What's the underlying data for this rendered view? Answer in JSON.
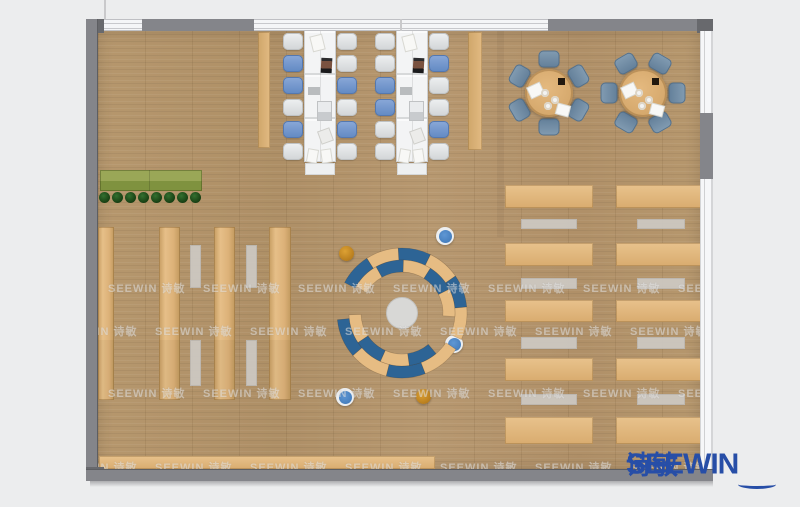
{
  "page": {
    "width": 800,
    "height": 507,
    "bg": "#ecedee"
  },
  "logo": {
    "en": "SEEWIN",
    "cn": "诗敏",
    "color": "#274ea7"
  },
  "watermark": {
    "text": "SEEWIN 诗敏",
    "tile": 95,
    "rows": [
      {
        "y": 280,
        "x0": 10
      },
      {
        "y": 323,
        "x0": -38
      },
      {
        "y": 385,
        "x0": 10
      },
      {
        "y": 459,
        "x0": -38
      }
    ]
  },
  "palette": {
    "wall": "#84858a",
    "wall_dark": "#68696d",
    "arc_blue": "#2d6495",
    "arc_tan": "#e6bc83",
    "hub": "#d8d8d6",
    "hub_edge": "#c2c2c0",
    "planter_top": "#9aa757",
    "planter_bottom": "#7f923f"
  },
  "room": {
    "floor": {
      "x": 98,
      "y": 31,
      "w": 602,
      "h": 438
    },
    "top_wall": {
      "y": 19,
      "h": 12,
      "segments": [
        {
          "x": 86,
          "w": 18,
          "t": "dark"
        },
        {
          "x": 104,
          "w": 38,
          "t": "glass"
        },
        {
          "x": 142,
          "w": 112,
          "t": "wall"
        },
        {
          "x": 254,
          "w": 294,
          "t": "glass"
        },
        {
          "x": 548,
          "w": 149,
          "t": "wall"
        },
        {
          "x": 697,
          "w": 16,
          "t": "dark"
        }
      ]
    },
    "glass_divider_x": 400,
    "left_wall": {
      "x": 86,
      "y": 19,
      "w": 12,
      "h": 462
    },
    "bottom_wall": {
      "x": 86,
      "y": 469,
      "w": 627,
      "h": 12
    },
    "right_window": {
      "x": 700,
      "y": 31,
      "w": 13,
      "h": 438,
      "gray_seg": {
        "y": 113,
        "h": 66
      }
    },
    "exterior_line": {
      "x": 104,
      "y": 0,
      "h": 19
    }
  },
  "furniture": {
    "planter": {
      "x": 100,
      "y": 170,
      "w": 102,
      "h": 21,
      "plants": {
        "n": 8,
        "y": 197,
        "x0": 104,
        "gap": 13,
        "d": 11
      }
    },
    "left_shelves": {
      "y": 227,
      "h": 173,
      "items": [
        {
          "x": 98,
          "w": 16
        },
        {
          "x": 159,
          "w": 21
        },
        {
          "x": 214,
          "w": 21
        },
        {
          "x": 269,
          "w": 22
        }
      ]
    },
    "left_benches": {
      "w": 11,
      "cols": [
        190,
        246
      ],
      "segs": [
        {
          "y": 245,
          "h": 43
        },
        {
          "y": 340,
          "h": 46
        }
      ]
    },
    "pillars": [
      {
        "x": 258,
        "y": 32,
        "w": 12,
        "h": 116
      },
      {
        "x": 468,
        "y": 32,
        "w": 14,
        "h": 118
      }
    ],
    "long_tables": {
      "y": 30,
      "w": 32,
      "h": 132,
      "cap_h": 12,
      "chair_w": 20,
      "chair_h": 17,
      "row_gap": 22,
      "first_cy": 41,
      "tables": [
        {
          "x": 304,
          "left": [
            "white",
            "blue",
            "blue",
            "white",
            "blue",
            "white"
          ],
          "right": [
            "white",
            "white",
            "blue",
            "white",
            "blue",
            "white"
          ]
        },
        {
          "x": 396,
          "left": [
            "white",
            "white",
            "blue",
            "blue",
            "white",
            "white"
          ],
          "right": [
            "white",
            "blue",
            "white",
            "white",
            "blue",
            "white"
          ]
        }
      ],
      "items": [
        {
          "t": "paper",
          "dx": 8,
          "dy": 6,
          "w": 11,
          "h": 14,
          "rot": -14
        },
        {
          "t": "laptop_dark",
          "dx": 17,
          "dy": 28,
          "w": 11,
          "h": 15,
          "rot": 3
        },
        {
          "t": "pad",
          "dx": 4,
          "dy": 57,
          "w": 12,
          "h": 8,
          "rot": 0
        },
        {
          "t": "laptop_light",
          "dx": 14,
          "dy": 72,
          "w": 13,
          "h": 18,
          "rot": 0
        },
        {
          "t": "tablet",
          "dx": 16,
          "dy": 100,
          "w": 11,
          "h": 12,
          "rot": -20
        },
        {
          "t": "paper",
          "dx": 4,
          "dy": 120,
          "w": 9,
          "h": 12,
          "rot": 10
        },
        {
          "t": "paper",
          "dx": 18,
          "dy": 120,
          "w": 9,
          "h": 12,
          "rot": -8
        }
      ]
    },
    "round_tables": {
      "r": 24,
      "chair_dist": 34,
      "chair_w": 21,
      "chair_h": 17,
      "tables": [
        {
          "cx": 549,
          "cy": 93,
          "angles": [
            0,
            60,
            120,
            180,
            240,
            300
          ]
        },
        {
          "cx": 643,
          "cy": 93,
          "angles": [
            30,
            90,
            150,
            210,
            270,
            330
          ]
        }
      ],
      "items": [
        {
          "t": "paper",
          "dx": -20,
          "dy": -8,
          "w": 13,
          "h": 11,
          "rot": -25
        },
        {
          "t": "paper",
          "dx": 8,
          "dy": 12,
          "w": 12,
          "h": 10,
          "rot": 15
        },
        {
          "t": "dark",
          "dx": 9,
          "dy": -15,
          "w": 7,
          "h": 7,
          "rot": 0
        },
        {
          "t": "plate",
          "dx": -8,
          "dy": -4,
          "w": 8,
          "h": 8,
          "rot": 0
        },
        {
          "t": "plate",
          "dx": 2,
          "dy": 3,
          "w": 8,
          "h": 8,
          "rot": 0
        },
        {
          "t": "plate",
          "dx": -5,
          "dy": 9,
          "w": 8,
          "h": 8,
          "rot": 0
        }
      ]
    },
    "right_desks": {
      "cols": [
        {
          "x": 505,
          "w": 88,
          "bx": 521,
          "bw": 56
        },
        {
          "x": 616,
          "w": 85,
          "bx": 637,
          "bw": 48
        }
      ],
      "rows": [
        {
          "y": 185,
          "h": 23
        },
        {
          "y": 243,
          "h": 23
        },
        {
          "y": 300,
          "h": 22
        },
        {
          "y": 358,
          "h": 23
        },
        {
          "y": 417,
          "h": 27
        }
      ],
      "bench_rows": [
        {
          "y": 219,
          "h": 10
        },
        {
          "y": 278,
          "h": 11
        },
        {
          "y": 337,
          "h": 12
        },
        {
          "y": 394,
          "h": 11
        }
      ]
    },
    "bottom_shelf": {
      "x": 99,
      "y": 456,
      "w": 336,
      "h": 13
    },
    "floor_shade": {
      "x": 497,
      "y": 31,
      "w": 7,
      "h": 206
    },
    "center_feature": {
      "cx": 402,
      "cy": 313,
      "hub_r": 15.5,
      "arcs": [
        {
          "bands": [
            {
              "r0": 53,
              "r1": 65,
              "a0": 152,
              "a1": -24,
              "colors": [
                "blue",
                "tan",
                "blue",
                "tan",
                "blue",
                "tan"
              ]
            },
            {
              "r0": 41,
              "r1": 53,
              "a0": 150,
              "a1": -4,
              "colors": [
                "tan",
                "blue",
                "tan",
                "blue",
                "tan"
              ]
            }
          ]
        },
        {
          "bands": [
            {
              "r0": 53,
              "r1": 65,
              "a0": -174,
              "a1": -34,
              "colors": [
                "blue",
                "tan",
                "blue",
                "tan"
              ]
            },
            {
              "r0": 41,
              "r1": 53,
              "a0": -178,
              "a1": -50,
              "colors": [
                "tan",
                "blue",
                "tan",
                "blue"
              ]
            }
          ]
        }
      ]
    },
    "stools": [
      {
        "x": 445,
        "y": 236,
        "c": "blue"
      },
      {
        "x": 346,
        "y": 253,
        "c": "orange"
      },
      {
        "x": 454,
        "y": 344,
        "c": "blue"
      },
      {
        "x": 423,
        "y": 396,
        "c": "orange"
      },
      {
        "x": 345,
        "y": 397,
        "c": "blue"
      }
    ]
  }
}
